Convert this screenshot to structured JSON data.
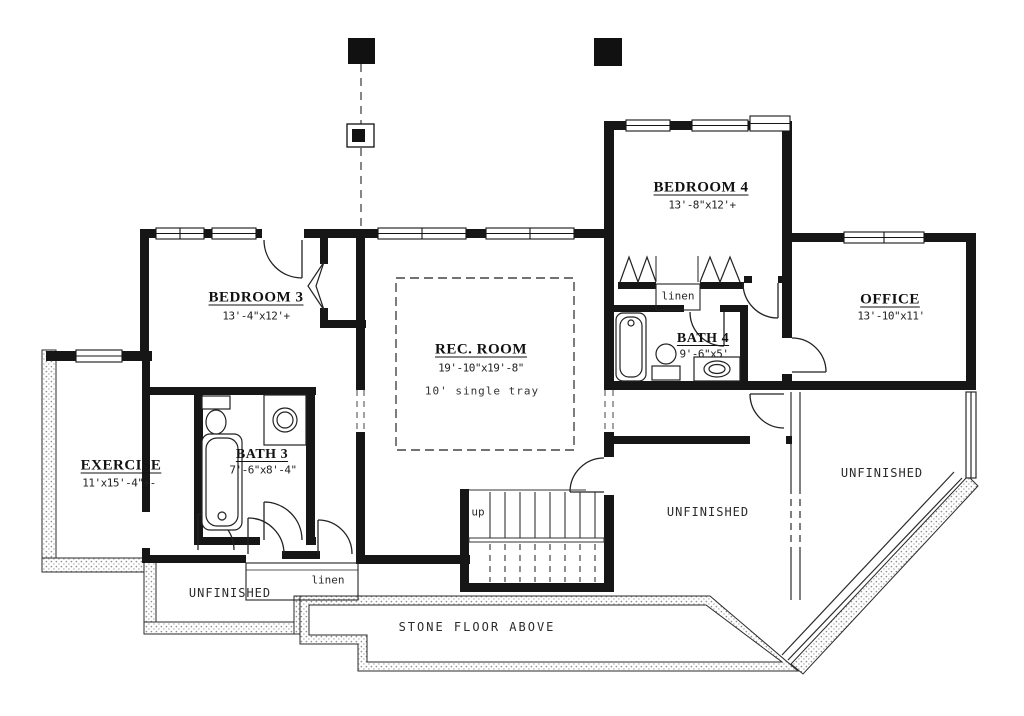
{
  "rooms": [
    {
      "label": "BEDROOM 3",
      "dims": "13'-4\"x12'+"
    },
    {
      "label": "REC. ROOM",
      "dims": "19'-10\"x19'-8\"",
      "note": "10' single tray"
    },
    {
      "label": "BEDROOM 4",
      "dims": "13'-8\"x12'+"
    },
    {
      "label": "OFFICE",
      "dims": "13'-10\"x11'"
    },
    {
      "label": "BATH 4",
      "dims": "9'-6\"x5'"
    },
    {
      "label": "EXERCISE",
      "dims": "11'x15'-4\"+-"
    },
    {
      "label": "BATH 3",
      "dims": "7'-6\"x8'-4\""
    }
  ],
  "annotations": {
    "unfinished_lower_left": "UNFINISHED",
    "unfinished_center": "UNFINISHED",
    "unfinished_right": "UNFINISHED",
    "stone_floor": "STONE FLOOR ABOVE",
    "linen_upper": "linen",
    "linen_lower": "linen",
    "stairs_up": "up"
  },
  "colors": {
    "wall": "#161616",
    "paper": "#ffffff",
    "dash": "#444444"
  }
}
